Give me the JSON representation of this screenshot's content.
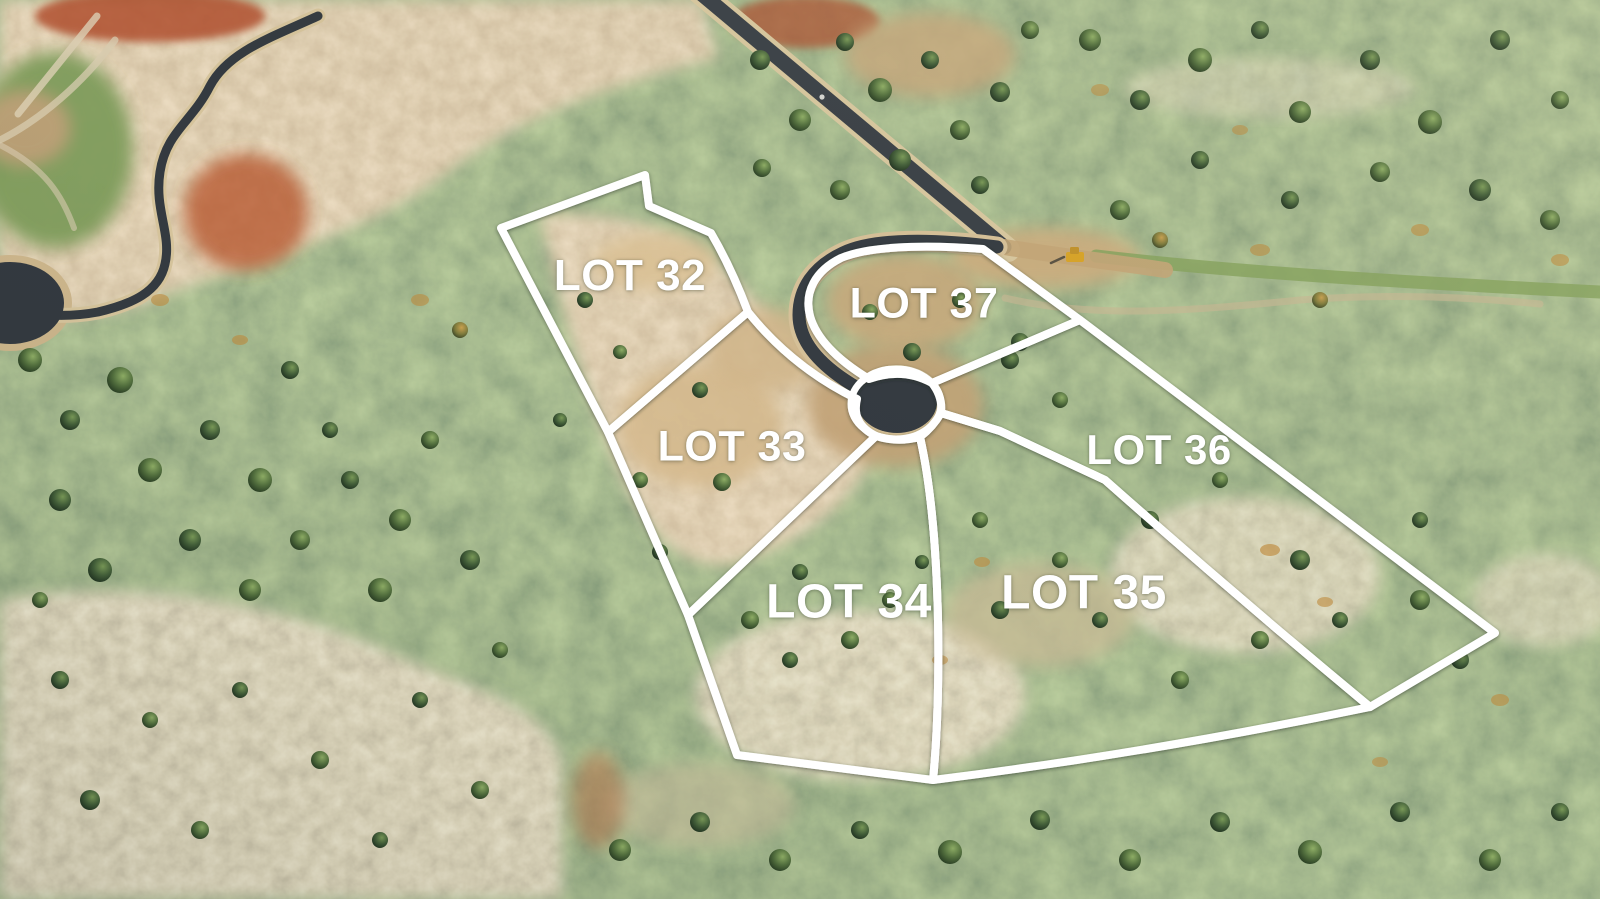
{
  "map": {
    "type": "aerial-lot-map",
    "labels": [
      {
        "id": "lot-32",
        "text": "LOT 32"
      },
      {
        "id": "lot-33",
        "text": "LOT 33"
      },
      {
        "id": "lot-34",
        "text": "LOT 34"
      },
      {
        "id": "lot-35",
        "text": "LOT 35"
      },
      {
        "id": "lot-36",
        "text": "LOT 36"
      },
      {
        "id": "lot-37",
        "text": "LOT 37"
      }
    ],
    "overlay": {
      "boundary_color": "#ffffff",
      "label_color": "#ffffff"
    }
  }
}
